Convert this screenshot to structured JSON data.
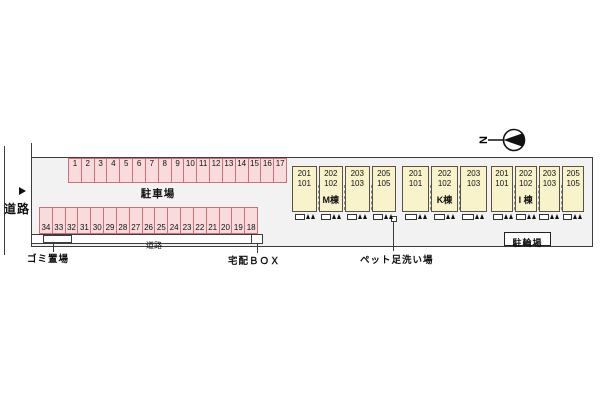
{
  "left_road": {
    "label": "道路",
    "arrow": "▶"
  },
  "parking": {
    "label": "駐車場",
    "top_row": [
      "1",
      "2",
      "3",
      "4",
      "5",
      "6",
      "7",
      "8",
      "9",
      "10",
      "11",
      "12",
      "13",
      "14",
      "15",
      "16",
      "17"
    ],
    "bottom_row": [
      "34",
      "33",
      "32",
      "31",
      "30",
      "29",
      "28",
      "27",
      "26",
      "25",
      "24",
      "23",
      "22",
      "21",
      "20",
      "19",
      "18"
    ]
  },
  "inner_road": {
    "label": "道路"
  },
  "garbage": {
    "label": "ゴミ置場"
  },
  "delivery": {
    "label": "宅配ＢＯＸ"
  },
  "pet_wash": {
    "label": "ペット足洗い場"
  },
  "bicycle": {
    "label": "駐輪場"
  },
  "compass": {
    "letter": "N"
  },
  "buildings": [
    {
      "name": "M棟",
      "units": [
        {
          "upper": "201",
          "lower": "101"
        },
        {
          "upper": "202",
          "lower": "102"
        },
        {
          "upper": "203",
          "lower": "103"
        },
        {
          "upper": "205",
          "lower": "105"
        }
      ]
    },
    {
      "name": "K棟",
      "units": [
        {
          "upper": "201",
          "lower": "101"
        },
        {
          "upper": "202",
          "lower": "102"
        },
        {
          "upper": "203",
          "lower": "103"
        }
      ]
    },
    {
      "name": "I 棟",
      "units": [
        {
          "upper": "201",
          "lower": "101"
        },
        {
          "upper": "202",
          "lower": "102"
        },
        {
          "upper": "203",
          "lower": "103"
        },
        {
          "upper": "205",
          "lower": "105"
        }
      ]
    }
  ],
  "colors": {
    "stall_fill": "#f9dbdc",
    "stall_border": "#c9707a",
    "building_fill": "#f8f3cb",
    "building_border": "#5a543e",
    "site_fill": "#f2f2f2",
    "line": "#3c3c3c"
  }
}
